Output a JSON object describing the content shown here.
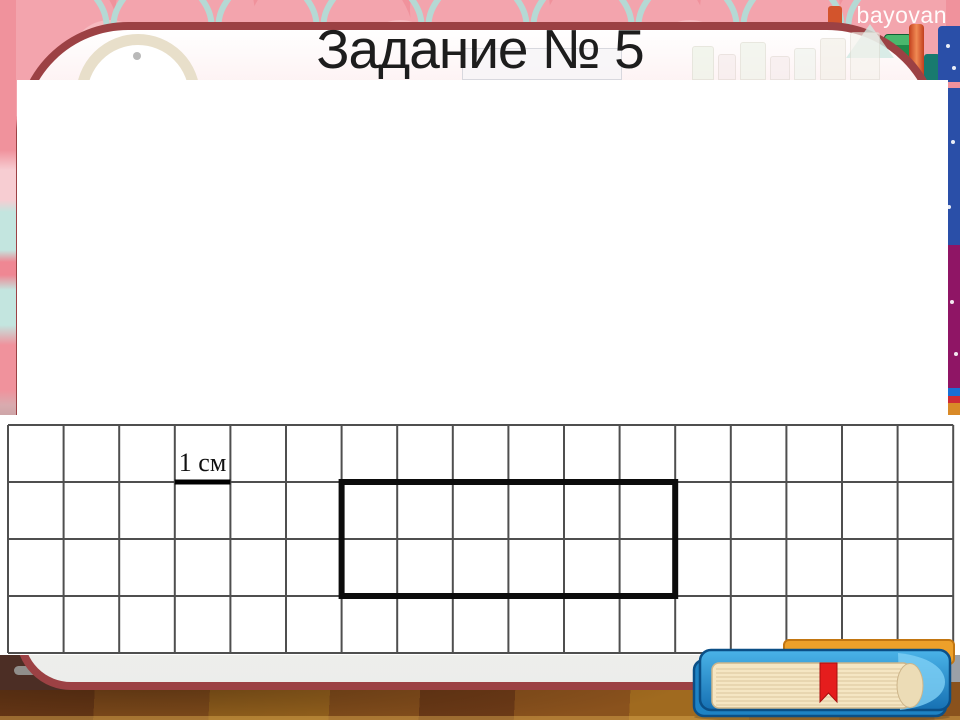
{
  "slide": {
    "title": "Задание № 5",
    "watermark": "bayovan"
  },
  "task_grid": {
    "unit_label": "1 см",
    "columns": 17,
    "rows": 4,
    "label_cell": {
      "col": 3,
      "row": 0
    },
    "rectangle": {
      "col_start": 6,
      "row_start": 1,
      "width_cells": 6,
      "height_cells": 2
    },
    "colors": {
      "grid_line": "#4f4f4f",
      "paper": "#ffffff",
      "rectangle_stroke": "#0c0c0c",
      "label_underline": "#000000",
      "label_text": "#111111"
    }
  },
  "theme": {
    "band_pink": "#f0929c",
    "border_maroon": "#9c4144",
    "floor_brown": "#7c451c",
    "book_blue": "#1e83c4"
  }
}
